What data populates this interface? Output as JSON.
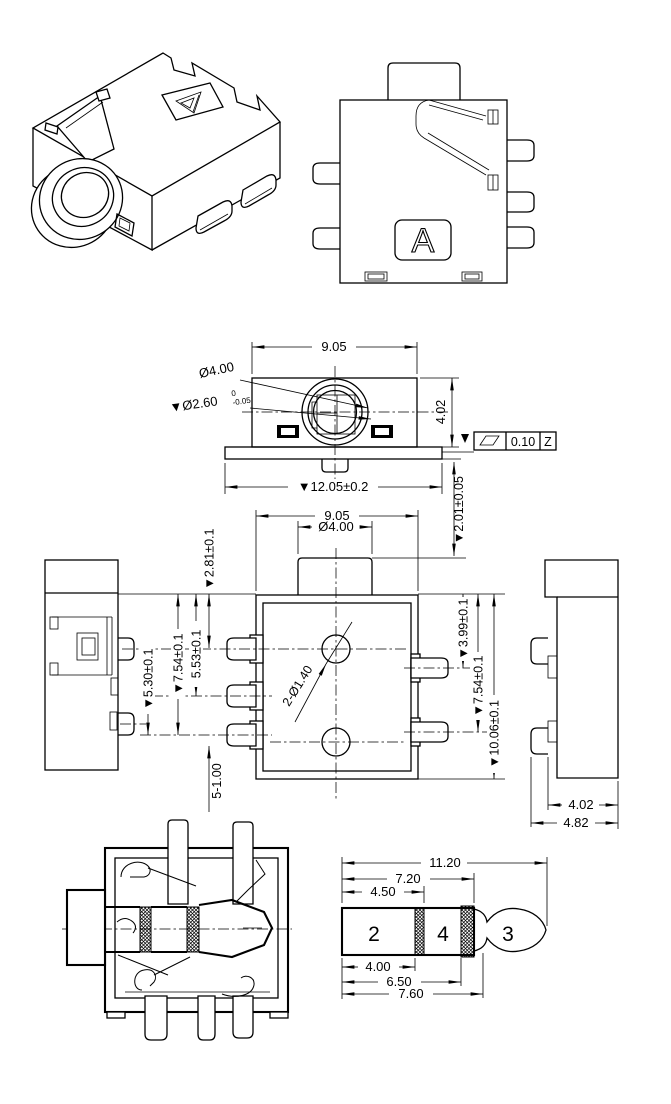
{
  "drawing": {
    "front": {
      "width": "9.05",
      "barrel_dia": "Ø4.00",
      "bore_dia": "▼Ø2.60",
      "bore_tol_upper": "0",
      "bore_tol_lower": "-0.05",
      "height": "4.02",
      "flange_width": "▼12.05±0.2",
      "gdt": {
        "tolerance": "0.10",
        "datum": "Z"
      }
    },
    "plan": {
      "width": "9.05",
      "boss_dia": "Ø4.00",
      "boss_height": "▼2.01±0.05",
      "pin1_offset": "▼2.81±0.1",
      "pin2_offset": "5.53±0.1",
      "pin3_offset": "▼7.54±0.1",
      "pin_span": "▼5.30±0.1",
      "pin_width": "5-1.00",
      "right_pin1_offset": "▼3.99±0.1",
      "right_pin2_offset": "▼7.54±0.1",
      "body_length": "▼10.06±0.1",
      "holes": "2-Ø1.40"
    },
    "right_side": {
      "depth": "4.02",
      "overall_depth": "4.82"
    },
    "top": {
      "marking": "A"
    },
    "plug": {
      "overall_length": "11.20",
      "to_ring_end": "7.20",
      "to_band1_end": "4.50",
      "sleeve_length": "4.00",
      "to_band2_start": "6.50",
      "to_neck": "7.60",
      "labels": {
        "sleeve": "2",
        "ring": "4",
        "tip": "3"
      }
    },
    "colors": {
      "line": "#000000",
      "plug_label_green": "#44cc44",
      "background": "#ffffff"
    }
  }
}
